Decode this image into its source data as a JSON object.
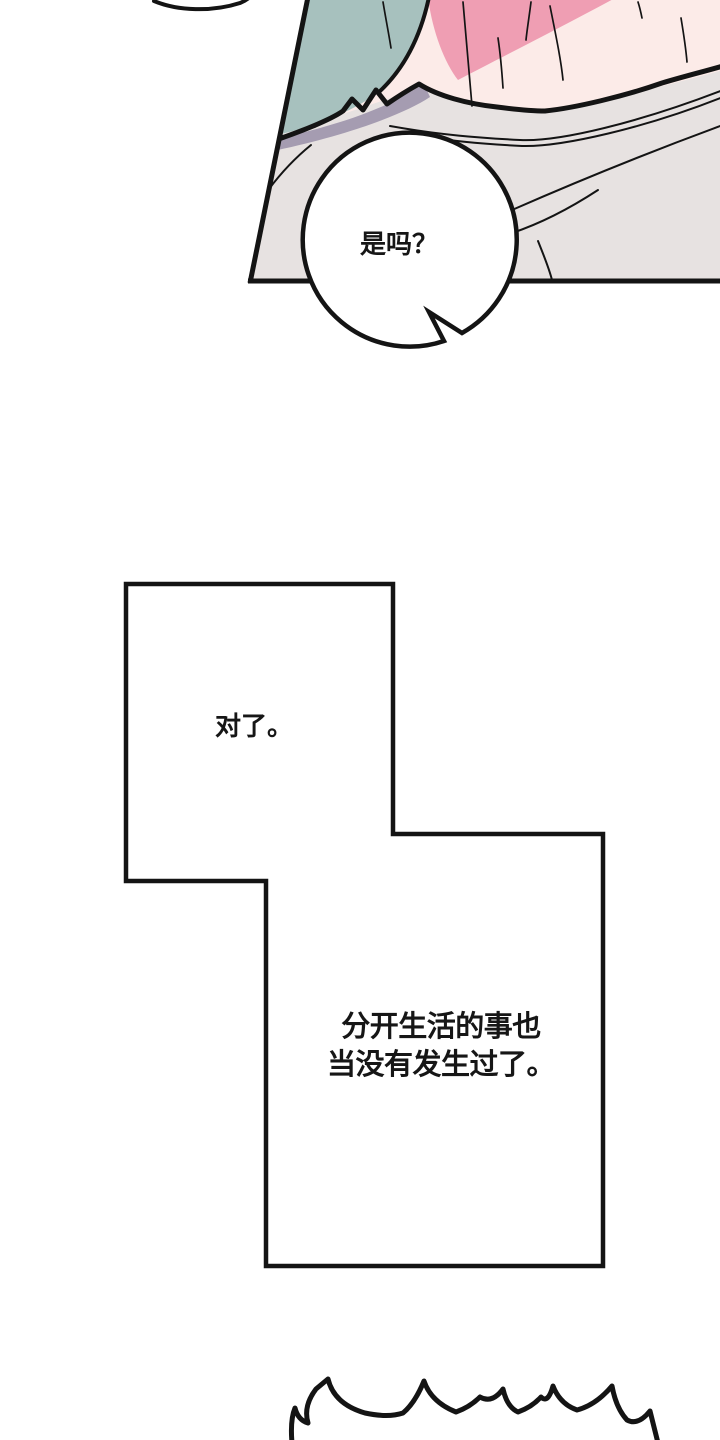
{
  "page": {
    "width": 720,
    "height": 1440
  },
  "colors": {
    "background": "#ffffff",
    "line": "#141414",
    "panel_fill": "#ffffff",
    "bubble_fill": "#ffffff"
  },
  "panel1": {
    "description": "bed-scene-art-panel",
    "bubble_text": "是吗？",
    "colors": {
      "teal_hair": "#a7c1be",
      "pink_hair": "#ef9eb3",
      "skin": "#fcebe8",
      "blanket": "#e7e2e1",
      "shadow": "#a59cb1"
    }
  },
  "panel2": {
    "caption": "对了。"
  },
  "panel3": {
    "caption_line1": "分开生活的事也",
    "caption_line2": "当没有发生过了。"
  }
}
